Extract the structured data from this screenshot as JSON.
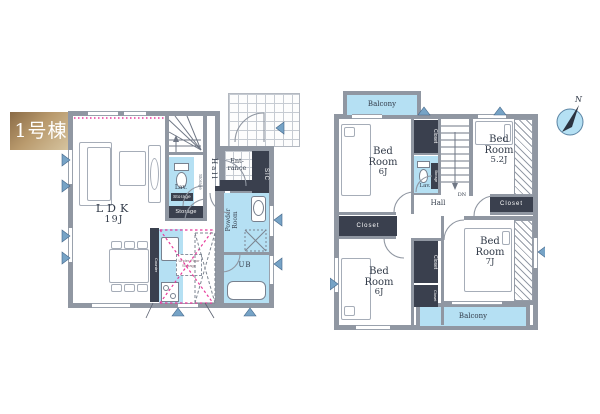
{
  "building_label": "1号棟",
  "compass": {
    "north_label": "N"
  },
  "floor1": {
    "ldk": {
      "name": "LDK",
      "size": "19J"
    },
    "hall": "Hall",
    "entrance_lines": [
      "Ent-",
      "rance"
    ],
    "sic": "SIC",
    "lav": "Lav.",
    "lav_storage_tag": "Storage",
    "storage_vertical": "Storage",
    "storage_room": "Storage",
    "powder_lines": [
      "Powder",
      "Room"
    ],
    "ub": "UB",
    "counter": "Counter",
    "under_floor_storage": "Under Floor Storage"
  },
  "floor2": {
    "balcony_top": "Balcony",
    "balcony_bottom": "Balcony",
    "hall": "Hall",
    "down_label": "DN",
    "lav": "Lav.",
    "lav_storage_tag": "Storage",
    "closet_label": "Closet",
    "bedrooms": {
      "top_left": {
        "name_lines": [
          "Bed",
          "Room"
        ],
        "size": "6J"
      },
      "top_right": {
        "name_lines": [
          "Bed",
          "Room"
        ],
        "size": "5.2J"
      },
      "bottom_left": {
        "name_lines": [
          "Bed",
          "Room"
        ],
        "size": "6J"
      },
      "bottom_right": {
        "name_lines": [
          "Bed",
          "Room"
        ],
        "size": "7J"
      }
    }
  },
  "colors": {
    "wall": "#9097a2",
    "water_blue": "#b5e0f3",
    "closet_dark": "#3a404e",
    "accent_pink": "#e8399a",
    "gold_dark": "#8a6b46",
    "gold_light": "#d8c7a3",
    "window_marker": "#76a3c6"
  }
}
